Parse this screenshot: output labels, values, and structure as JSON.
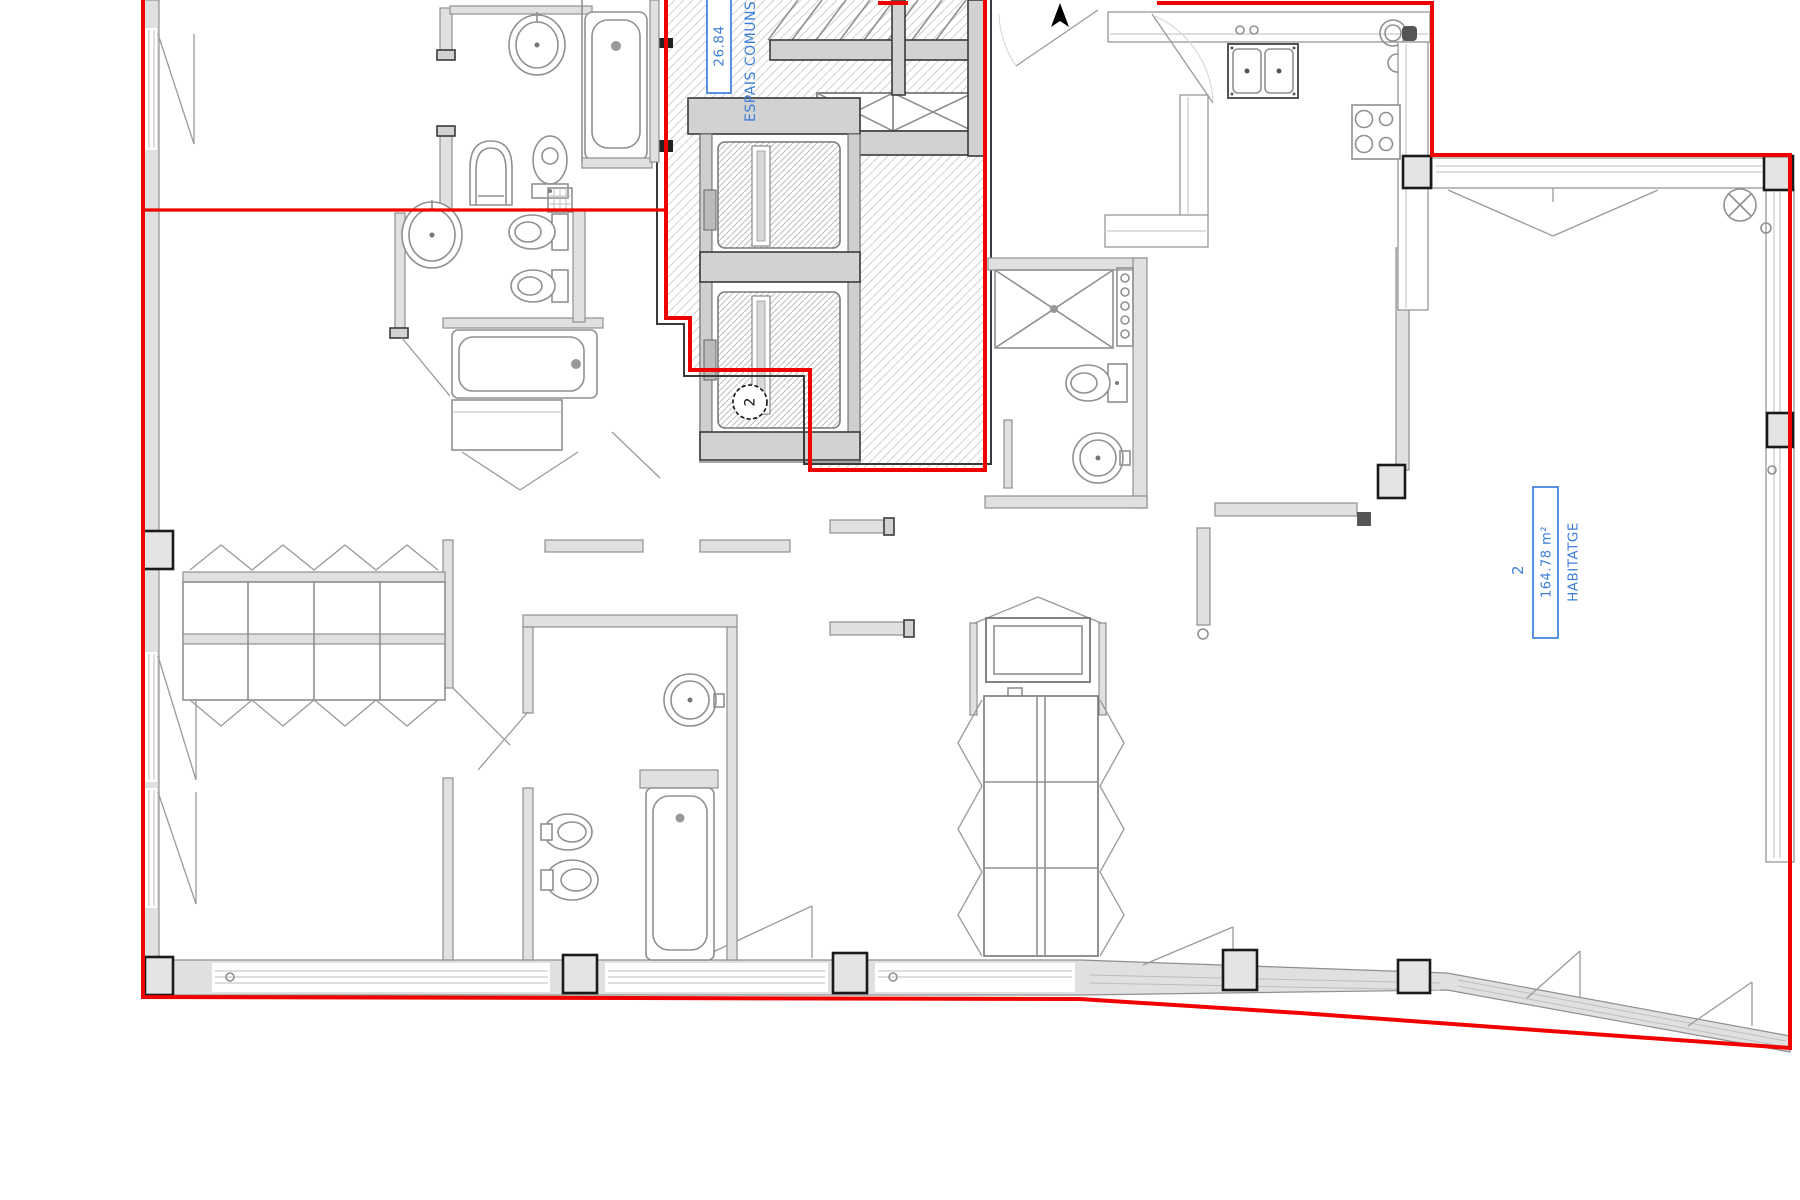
{
  "plan": {
    "type": "architectural-floor-plan",
    "common_area_label": {
      "area": "26.84",
      "name": "ESPAIS COMUNS"
    },
    "unit_label": {
      "number": "2",
      "area": "164.78 m²",
      "name": "HABITATGE"
    },
    "door_marker": "2",
    "icons": {
      "entrance_arrow": "up-arrow-icon",
      "ceiling_light": "circle-cross-icon",
      "shower_tray": "x-cross-icon",
      "vent_duct": "x-cross-icon"
    },
    "colors": {
      "boundary": "#f20000",
      "label": "#3d7fd9",
      "walls": "#e0e0e0",
      "wline": "#8f8f8f",
      "fixture": "#909090",
      "column": "#1a1a1a",
      "darkln": "#3a3a3a",
      "hatch": "#d0d0d0"
    }
  }
}
